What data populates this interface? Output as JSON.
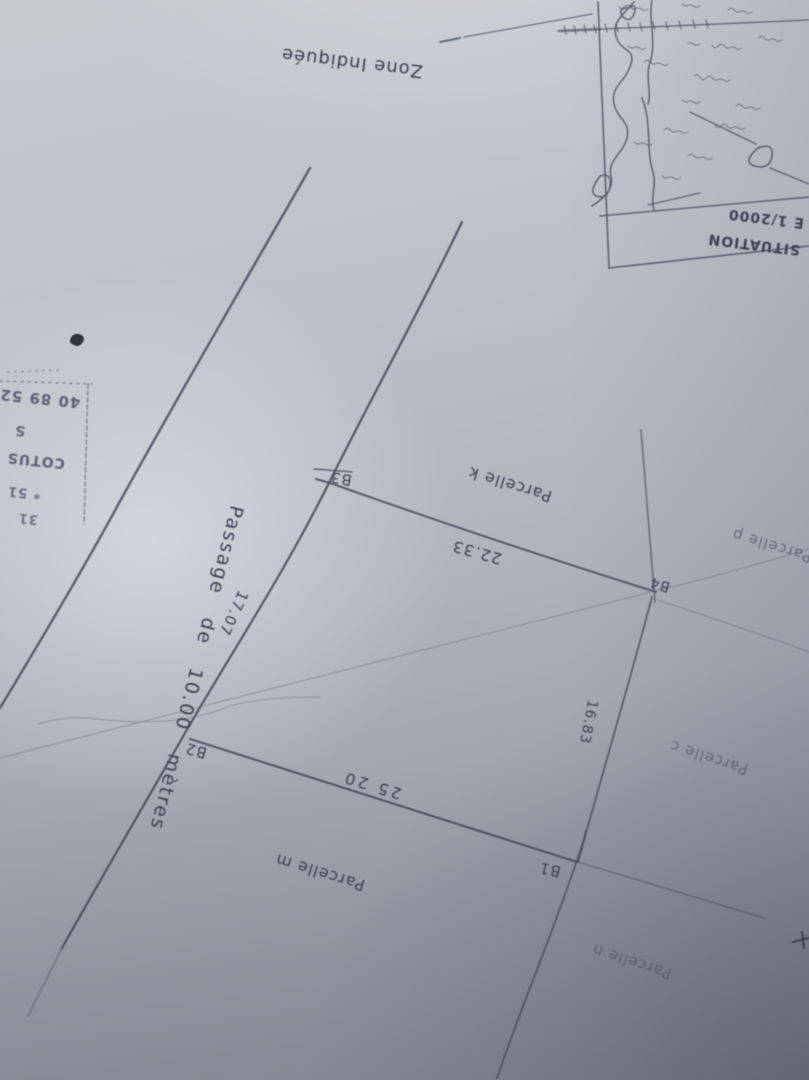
{
  "colors": {
    "ink": "#3d4152",
    "faint_ink": "#6a6f80",
    "paper_light": "#c7cacf",
    "paper_dark": "#8b8e99"
  },
  "callout": {
    "label": "Zone Indiquée"
  },
  "inset_map": {
    "situation_label": "SITUATION",
    "scale_label": "E 1/2000"
  },
  "plan": {
    "passage_label": "Passage de 10.00 mètres",
    "markers": [
      {
        "id": "B1"
      },
      {
        "id": "B2"
      },
      {
        "id": "B3"
      },
      {
        "id": "B4"
      }
    ],
    "measurements": [
      {
        "value": "17.07"
      },
      {
        "value": "22.33"
      },
      {
        "value": "25 20"
      },
      {
        "value": "16.83"
      }
    ],
    "parcels": [
      {
        "label": "Parcelle k"
      },
      {
        "label": "Parcelle m"
      },
      {
        "label": "Parcelle n"
      },
      {
        "label": "Parcelle c"
      },
      {
        "label": "Parcelle p"
      }
    ]
  },
  "stamp": {
    "lines": [
      "40 89 52",
      "S",
      "COTUS",
      "* 51",
      "31"
    ]
  }
}
